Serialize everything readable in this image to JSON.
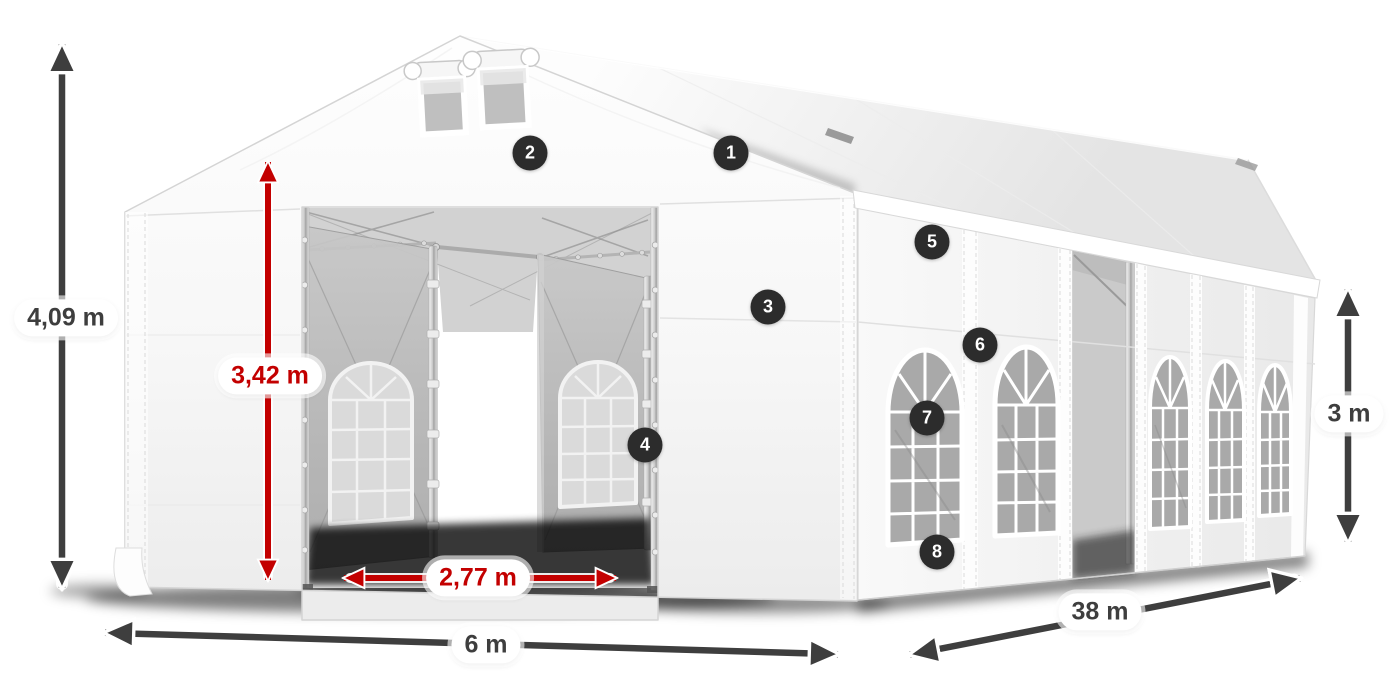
{
  "diagram": {
    "subject": "marquee tent dimension diagram",
    "dimensions": {
      "total_height": "4,09 m",
      "entrance_height": "3,42 m",
      "entrance_width": "2,77 m",
      "front_width": "6 m",
      "side_length": "38 m",
      "wall_height": "3 m"
    },
    "callouts": [
      "1",
      "2",
      "3",
      "4",
      "5",
      "6",
      "7",
      "8"
    ],
    "colors": {
      "dimension_red": "#c30000",
      "dimension_dark": "#3e3e3e",
      "badge_bg": "#2c2c2c",
      "label_bg": "#ffffff"
    }
  }
}
